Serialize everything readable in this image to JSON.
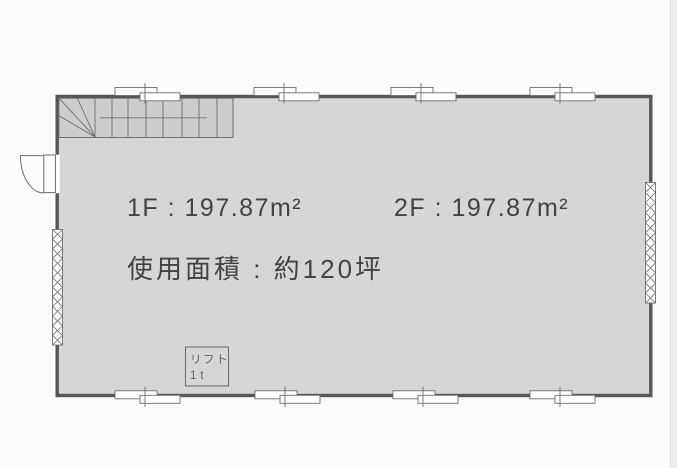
{
  "texts": {
    "area_1f": "1F : 197.87m²",
    "area_2f": "2F : 197.87m²",
    "usage_area": "使用面積 : 約120坪",
    "lift_name": "リフト",
    "lift_capacity": "1t"
  },
  "plan": {
    "floors": [
      {
        "floor": "1F",
        "area_sqm": 197.87
      },
      {
        "floor": "2F",
        "area_sqm": 197.87
      }
    ],
    "usage_area_tsubo": 120,
    "lift_capacity_tons": 1,
    "features": [
      "staircase",
      "entrance-door",
      "shutter-left",
      "shutter-right",
      "top-windows-4",
      "bottom-windows-4",
      "lift-shaft"
    ]
  },
  "colors": {
    "background": "#fcfcfc",
    "wall": "#54575a",
    "floor_fill": "#d5d7d6",
    "stair_fill": "#cbcecd",
    "line": "#6b6e70",
    "text": "#404346",
    "lift_text": "#63666a",
    "page_edge": "#ededed"
  }
}
